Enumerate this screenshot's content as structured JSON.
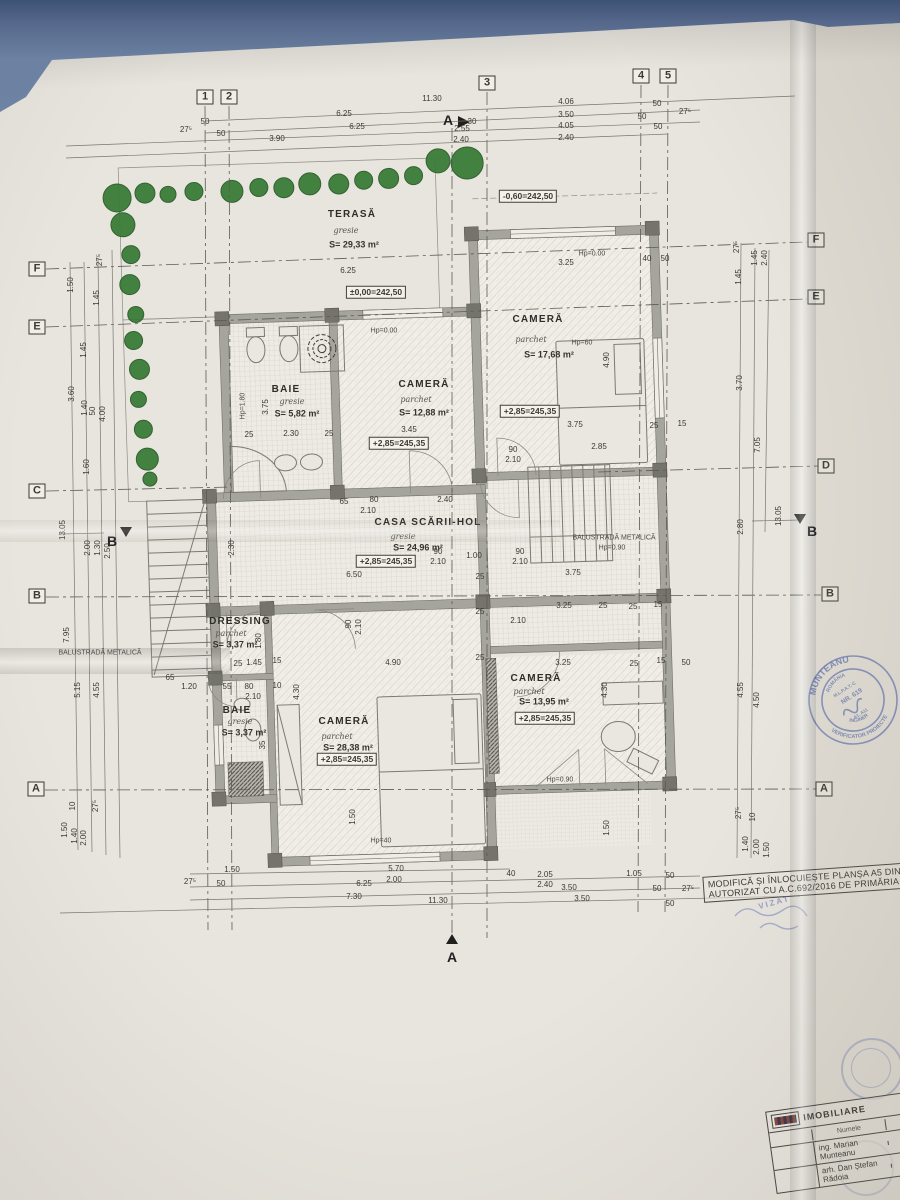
{
  "colors": {
    "paper": "#e8e5de",
    "background_blue": "#55688b",
    "tree_green": "#3a7c38",
    "stamp_blue": "#6e7fba",
    "ink": "#3b3a35"
  },
  "note_box": {
    "line1": "MODIFICĂ ȘI ÎNLOCUIEȘTE PLANȘA A5 DIN PR",
    "line2": "AUTORIZAT CU A.C.692/2016 DE PRIMĂRIA CO"
  },
  "title_block": {
    "company": "IMOBILIARE",
    "col_name": "Numele",
    "col_sign": "Semnătura",
    "designer": "ing. Marian Munteanu",
    "architect": "arh. Dan Ștefan Rădoia"
  },
  "stamp": {
    "name": "MUNTEANU",
    "country": "ROMÂNIA",
    "org": "M.L.P.A.T.-C",
    "nr": "NR. 619",
    "grades": "A1, A11",
    "title": "INGINER",
    "role": "VERIFICATOR PROIECTE"
  },
  "vizat": "VIZAT",
  "plan": {
    "trees": [
      [
        128,
        188,
        14
      ],
      [
        156,
        184,
        10
      ],
      [
        179,
        186,
        8
      ],
      [
        205,
        184,
        9
      ],
      [
        243,
        185,
        11
      ],
      [
        270,
        182,
        9
      ],
      [
        295,
        183,
        10
      ],
      [
        321,
        180,
        11
      ],
      [
        350,
        181,
        10
      ],
      [
        375,
        178,
        9
      ],
      [
        400,
        177,
        10
      ],
      [
        425,
        175,
        9
      ],
      [
        450,
        161,
        12
      ],
      [
        479,
        164,
        16
      ],
      [
        133,
        215,
        12
      ],
      [
        140,
        245,
        9
      ],
      [
        138,
        275,
        10
      ],
      [
        143,
        305,
        8
      ],
      [
        140,
        331,
        9
      ],
      [
        145,
        360,
        10
      ],
      [
        143,
        390,
        8
      ],
      [
        147,
        420,
        9
      ],
      [
        150,
        450,
        11
      ],
      [
        152,
        470,
        7
      ]
    ],
    "labels": [
      {
        "t": "1",
        "x": 205,
        "y": 97,
        "c": "gb"
      },
      {
        "t": "2",
        "x": 229,
        "y": 97,
        "c": "gb"
      },
      {
        "t": "3",
        "x": 487,
        "y": 83,
        "c": "gb"
      },
      {
        "t": "4",
        "x": 641,
        "y": 76,
        "c": "gb"
      },
      {
        "t": "5",
        "x": 668,
        "y": 76,
        "c": "gb"
      },
      {
        "t": "F",
        "x": 37,
        "y": 269,
        "c": "gb"
      },
      {
        "t": "E",
        "x": 37,
        "y": 327,
        "c": "gb"
      },
      {
        "t": "C",
        "x": 37,
        "y": 491,
        "c": "gb"
      },
      {
        "t": "B",
        "x": 37,
        "y": 596,
        "c": "gb"
      },
      {
        "t": "A",
        "x": 36,
        "y": 789,
        "c": "gb"
      },
      {
        "t": "F",
        "x": 816,
        "y": 240,
        "c": "gb"
      },
      {
        "t": "E",
        "x": 816,
        "y": 297,
        "c": "gb"
      },
      {
        "t": "D",
        "x": 826,
        "y": 466,
        "c": "gb"
      },
      {
        "t": "B",
        "x": 830,
        "y": 594,
        "c": "gb"
      },
      {
        "t": "A",
        "x": 824,
        "y": 789,
        "c": "gb"
      },
      {
        "t": "A",
        "x": 448,
        "y": 120,
        "c": "sec"
      },
      {
        "t": "A",
        "x": 452,
        "y": 957,
        "c": "sec"
      },
      {
        "t": "B",
        "x": 112,
        "y": 541,
        "c": "sec"
      },
      {
        "t": "B",
        "x": 812,
        "y": 531,
        "c": "sec"
      },
      {
        "t": "TERASĂ",
        "x": 352,
        "y": 215,
        "c": "room"
      },
      {
        "t": "gresie",
        "x": 346,
        "y": 231,
        "c": "flr"
      },
      {
        "t": "S= 29,33 m²",
        "x": 354,
        "y": 245,
        "c": "area"
      },
      {
        "t": "CAMERĂ",
        "x": 538,
        "y": 320,
        "c": "room"
      },
      {
        "t": "parchet",
        "x": 531,
        "y": 340,
        "c": "flr"
      },
      {
        "t": "S= 17,68 m²",
        "x": 549,
        "y": 355,
        "c": "area"
      },
      {
        "t": "BAIE",
        "x": 286,
        "y": 390,
        "c": "room"
      },
      {
        "t": "gresie",
        "x": 292,
        "y": 402,
        "c": "flr"
      },
      {
        "t": "S= 5,82 m²",
        "x": 297,
        "y": 414,
        "c": "area"
      },
      {
        "t": "CAMERĂ",
        "x": 424,
        "y": 385,
        "c": "room"
      },
      {
        "t": "parchet",
        "x": 416,
        "y": 400,
        "c": "flr"
      },
      {
        "t": "S= 12,88 m²",
        "x": 424,
        "y": 413,
        "c": "area"
      },
      {
        "t": "CASA SCĂRII-HOL",
        "x": 428,
        "y": 523,
        "c": "room"
      },
      {
        "t": "gresie",
        "x": 403,
        "y": 537,
        "c": "flr"
      },
      {
        "t": "S= 24,96 m²",
        "x": 418,
        "y": 548,
        "c": "area"
      },
      {
        "t": "DRESSING",
        "x": 240,
        "y": 622,
        "c": "room"
      },
      {
        "t": "parchet",
        "x": 231,
        "y": 634,
        "c": "flr"
      },
      {
        "t": "S= 3,37 m²",
        "x": 235,
        "y": 645,
        "c": "area"
      },
      {
        "t": "BAIE",
        "x": 237,
        "y": 711,
        "c": "room"
      },
      {
        "t": "gresie",
        "x": 240,
        "y": 722,
        "c": "flr"
      },
      {
        "t": "S= 3,37 m²",
        "x": 244,
        "y": 733,
        "c": "area"
      },
      {
        "t": "CAMERĂ",
        "x": 344,
        "y": 722,
        "c": "room"
      },
      {
        "t": "parchet",
        "x": 337,
        "y": 737,
        "c": "flr"
      },
      {
        "t": "S= 28,38 m²",
        "x": 348,
        "y": 748,
        "c": "area"
      },
      {
        "t": "CAMERĂ",
        "x": 536,
        "y": 679,
        "c": "room"
      },
      {
        "t": "parchet",
        "x": 529,
        "y": 692,
        "c": "flr"
      },
      {
        "t": "S= 13,95 m²",
        "x": 544,
        "y": 702,
        "c": "area"
      },
      {
        "t": "-0,60=242,50",
        "x": 528,
        "y": 196,
        "c": "elev"
      },
      {
        "t": "±0,00=242,50",
        "x": 376,
        "y": 292,
        "c": "elev"
      },
      {
        "t": "+2,85=245,35",
        "x": 530,
        "y": 411,
        "c": "elev"
      },
      {
        "t": "+2,85=245,35",
        "x": 399,
        "y": 443,
        "c": "elev"
      },
      {
        "t": "+2,85=245,35",
        "x": 386,
        "y": 561,
        "c": "elev"
      },
      {
        "t": "+2,85=245,35",
        "x": 347,
        "y": 759,
        "c": "elev"
      },
      {
        "t": "+2,85=245,35",
        "x": 545,
        "y": 718,
        "c": "elev"
      },
      {
        "t": "Hp=0.00",
        "x": 592,
        "y": 254,
        "c": "ann"
      },
      {
        "t": "Hp=60",
        "x": 582,
        "y": 343,
        "c": "ann"
      },
      {
        "t": "Hp=0.00",
        "x": 384,
        "y": 331,
        "c": "ann"
      },
      {
        "t": "Hp=1.80",
        "x": 243,
        "y": 406,
        "r": -90,
        "c": "ann"
      },
      {
        "t": "BALUSTRADĂ METALICĂ",
        "x": 614,
        "y": 538,
        "c": "ann"
      },
      {
        "t": "Hp=0.90",
        "x": 612,
        "y": 548,
        "c": "ann"
      },
      {
        "t": "BALUSTRADĂ METALICĂ",
        "x": 100,
        "y": 653,
        "c": "ann"
      },
      {
        "t": "Hp=0.90",
        "x": 560,
        "y": 780,
        "c": "ann"
      },
      {
        "t": "Hp=40",
        "x": 381,
        "y": 841,
        "c": "ann"
      },
      {
        "t": "11.30",
        "x": 432,
        "y": 99
      },
      {
        "t": "6.25",
        "x": 344,
        "y": 114
      },
      {
        "t": "6.25",
        "x": 357,
        "y": 127
      },
      {
        "t": "3.90",
        "x": 277,
        "y": 139
      },
      {
        "t": "2.55",
        "x": 462,
        "y": 129
      },
      {
        "t": "2.40",
        "x": 461,
        "y": 140
      },
      {
        "t": "50",
        "x": 205,
        "y": 122
      },
      {
        "t": "50",
        "x": 221,
        "y": 134
      },
      {
        "t": "27⁵",
        "x": 186,
        "y": 130
      },
      {
        "t": "30",
        "x": 472,
        "y": 122
      },
      {
        "t": "4.06",
        "x": 566,
        "y": 102
      },
      {
        "t": "3.50",
        "x": 566,
        "y": 115
      },
      {
        "t": "4.05",
        "x": 566,
        "y": 126
      },
      {
        "t": "2.40",
        "x": 566,
        "y": 138
      },
      {
        "t": "50",
        "x": 657,
        "y": 104
      },
      {
        "t": "50",
        "x": 642,
        "y": 117
      },
      {
        "t": "50",
        "x": 658,
        "y": 127
      },
      {
        "t": "27⁵",
        "x": 685,
        "y": 112
      },
      {
        "t": "27⁵",
        "x": 190,
        "y": 882
      },
      {
        "t": "50",
        "x": 221,
        "y": 884
      },
      {
        "t": "1.50",
        "x": 232,
        "y": 870
      },
      {
        "t": "5.70",
        "x": 396,
        "y": 869
      },
      {
        "t": "2.00",
        "x": 394,
        "y": 880
      },
      {
        "t": "6.25",
        "x": 364,
        "y": 884
      },
      {
        "t": "7.30",
        "x": 354,
        "y": 897
      },
      {
        "t": "11.30",
        "x": 438,
        "y": 901
      },
      {
        "t": "40",
        "x": 511,
        "y": 874
      },
      {
        "t": "2.05",
        "x": 545,
        "y": 875
      },
      {
        "t": "2.40",
        "x": 545,
        "y": 885
      },
      {
        "t": "3.50",
        "x": 569,
        "y": 888
      },
      {
        "t": "1.05",
        "x": 634,
        "y": 874
      },
      {
        "t": "50",
        "x": 670,
        "y": 876
      },
      {
        "t": "50",
        "x": 657,
        "y": 889
      },
      {
        "t": "27⁵",
        "x": 688,
        "y": 889
      },
      {
        "t": "3.50",
        "x": 582,
        "y": 899
      },
      {
        "t": "50",
        "x": 670,
        "y": 904
      },
      {
        "t": "27⁵",
        "x": 100,
        "y": 260,
        "r": -90
      },
      {
        "t": "1.50",
        "x": 71,
        "y": 285,
        "r": -90
      },
      {
        "t": "1.45",
        "x": 97,
        "y": 298,
        "r": -90
      },
      {
        "t": "1.45",
        "x": 84,
        "y": 350,
        "r": -90
      },
      {
        "t": "3.60",
        "x": 72,
        "y": 394,
        "r": -90
      },
      {
        "t": "1.40",
        "x": 85,
        "y": 408,
        "r": -90
      },
      {
        "t": "50",
        "x": 93,
        "y": 411,
        "r": -90
      },
      {
        "t": "4.00",
        "x": 103,
        "y": 414,
        "r": -90
      },
      {
        "t": "1.60",
        "x": 87,
        "y": 467,
        "r": -90
      },
      {
        "t": "13.05",
        "x": 63,
        "y": 530,
        "r": -90
      },
      {
        "t": "2.00",
        "x": 88,
        "y": 548,
        "r": -90
      },
      {
        "t": "1.30",
        "x": 98,
        "y": 548,
        "r": -90
      },
      {
        "t": "2.50",
        "x": 108,
        "y": 551,
        "r": -90
      },
      {
        "t": "7.95",
        "x": 67,
        "y": 635,
        "r": -90
      },
      {
        "t": "5.15",
        "x": 78,
        "y": 690,
        "r": -90
      },
      {
        "t": "4.55",
        "x": 97,
        "y": 690,
        "r": -90
      },
      {
        "t": "1.50",
        "x": 65,
        "y": 830,
        "r": -90
      },
      {
        "t": "1.40",
        "x": 75,
        "y": 836,
        "r": -90
      },
      {
        "t": "10",
        "x": 73,
        "y": 806,
        "r": -90
      },
      {
        "t": "2.00",
        "x": 84,
        "y": 838,
        "r": -90
      },
      {
        "t": "27⁵",
        "x": 96,
        "y": 806,
        "r": -90
      },
      {
        "t": "27⁵",
        "x": 737,
        "y": 247,
        "r": -90
      },
      {
        "t": "1.45",
        "x": 755,
        "y": 258,
        "r": -90
      },
      {
        "t": "2.40",
        "x": 765,
        "y": 258,
        "r": -90
      },
      {
        "t": "1.45",
        "x": 739,
        "y": 277,
        "r": -90
      },
      {
        "t": "3.70",
        "x": 740,
        "y": 383,
        "r": -90
      },
      {
        "t": "7.05",
        "x": 758,
        "y": 445,
        "r": -90
      },
      {
        "t": "13.05",
        "x": 779,
        "y": 516,
        "r": -90
      },
      {
        "t": "2.80",
        "x": 741,
        "y": 527,
        "r": -90
      },
      {
        "t": "4.55",
        "x": 741,
        "y": 690,
        "r": -90
      },
      {
        "t": "4.50",
        "x": 757,
        "y": 700,
        "r": -90
      },
      {
        "t": "27⁵",
        "x": 739,
        "y": 813,
        "r": -90
      },
      {
        "t": "10",
        "x": 753,
        "y": 817,
        "r": -90
      },
      {
        "t": "1.40",
        "x": 746,
        "y": 844,
        "r": -90
      },
      {
        "t": "2.00",
        "x": 757,
        "y": 847,
        "r": -90
      },
      {
        "t": "1.50",
        "x": 767,
        "y": 850,
        "r": -90
      },
      {
        "t": "6.25",
        "x": 348,
        "y": 271
      },
      {
        "t": "3.25",
        "x": 566,
        "y": 263
      },
      {
        "t": "40",
        "x": 647,
        "y": 259
      },
      {
        "t": "50",
        "x": 665,
        "y": 259
      },
      {
        "t": "4.90",
        "x": 607,
        "y": 360,
        "r": -90
      },
      {
        "t": "3.75",
        "x": 575,
        "y": 425
      },
      {
        "t": "25",
        "x": 654,
        "y": 426
      },
      {
        "t": "15",
        "x": 682,
        "y": 424
      },
      {
        "t": "2.85",
        "x": 599,
        "y": 447
      },
      {
        "t": "90",
        "x": 513,
        "y": 450
      },
      {
        "t": "2.10",
        "x": 513,
        "y": 460
      },
      {
        "t": "3.75",
        "x": 266,
        "y": 407,
        "r": -90
      },
      {
        "t": "2.30",
        "x": 291,
        "y": 434
      },
      {
        "t": "25",
        "x": 249,
        "y": 435
      },
      {
        "t": "25",
        "x": 329,
        "y": 434
      },
      {
        "t": "3.45",
        "x": 409,
        "y": 430
      },
      {
        "t": "65",
        "x": 344,
        "y": 502
      },
      {
        "t": "80",
        "x": 374,
        "y": 500
      },
      {
        "t": "2.10",
        "x": 368,
        "y": 511
      },
      {
        "t": "2.40",
        "x": 445,
        "y": 500
      },
      {
        "t": "90",
        "x": 438,
        "y": 552
      },
      {
        "t": "2.10",
        "x": 438,
        "y": 562
      },
      {
        "t": "1.00",
        "x": 474,
        "y": 556
      },
      {
        "t": "90",
        "x": 520,
        "y": 552
      },
      {
        "t": "2.10",
        "x": 520,
        "y": 562
      },
      {
        "t": "6.50",
        "x": 354,
        "y": 575
      },
      {
        "t": "25",
        "x": 480,
        "y": 577
      },
      {
        "t": "3.75",
        "x": 573,
        "y": 573
      },
      {
        "t": "3.25",
        "x": 564,
        "y": 606
      },
      {
        "t": "25",
        "x": 603,
        "y": 606
      },
      {
        "t": "25",
        "x": 633,
        "y": 607
      },
      {
        "t": "15",
        "x": 658,
        "y": 605
      },
      {
        "t": "2.10",
        "x": 518,
        "y": 621
      },
      {
        "t": "25",
        "x": 480,
        "y": 612
      },
      {
        "t": "2.30",
        "x": 232,
        "y": 548,
        "r": -90
      },
      {
        "t": "25",
        "x": 238,
        "y": 664
      },
      {
        "t": "1.45",
        "x": 254,
        "y": 663
      },
      {
        "t": "15",
        "x": 277,
        "y": 661
      },
      {
        "t": "90",
        "x": 349,
        "y": 624,
        "r": -90
      },
      {
        "t": "2.10",
        "x": 359,
        "y": 627,
        "r": -90
      },
      {
        "t": "1.80",
        "x": 259,
        "y": 641,
        "r": -90
      },
      {
        "t": "55",
        "x": 227,
        "y": 687
      },
      {
        "t": "80",
        "x": 249,
        "y": 687
      },
      {
        "t": "2.10",
        "x": 253,
        "y": 697
      },
      {
        "t": "10",
        "x": 277,
        "y": 686
      },
      {
        "t": "4.90",
        "x": 393,
        "y": 663
      },
      {
        "t": "25",
        "x": 480,
        "y": 658
      },
      {
        "t": "3.25",
        "x": 563,
        "y": 663
      },
      {
        "t": "25",
        "x": 634,
        "y": 664
      },
      {
        "t": "15",
        "x": 661,
        "y": 661
      },
      {
        "t": "50",
        "x": 686,
        "y": 663
      },
      {
        "t": "4.30",
        "x": 605,
        "y": 690,
        "r": -90
      },
      {
        "t": "4.30",
        "x": 297,
        "y": 692,
        "r": -90
      },
      {
        "t": "1.50",
        "x": 353,
        "y": 817,
        "r": -90
      },
      {
        "t": "1.50",
        "x": 607,
        "y": 828,
        "r": -90
      },
      {
        "t": "35",
        "x": 263,
        "y": 745,
        "r": -90
      },
      {
        "t": "65",
        "x": 170,
        "y": 678
      },
      {
        "t": "1.20",
        "x": 189,
        "y": 687
      }
    ]
  }
}
